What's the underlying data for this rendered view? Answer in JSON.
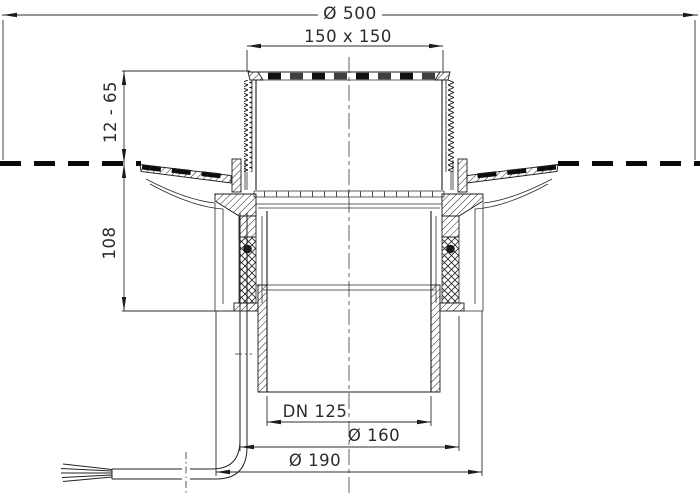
{
  "drawing": {
    "title": "drain-cross-section",
    "dims": {
      "top_diameter": "Ø 500",
      "grate_size": "150 x 150",
      "height_adjust": "12 - 65",
      "install_depth": "108",
      "outlet": "DN 125",
      "spigot_od": "Ø 160",
      "body_od": "Ø 190"
    },
    "colors": {
      "line": "#1c1c1c",
      "dim_text": "#2b2b2b",
      "membrane": "#0a0a0a",
      "background": "#ffffff"
    }
  }
}
